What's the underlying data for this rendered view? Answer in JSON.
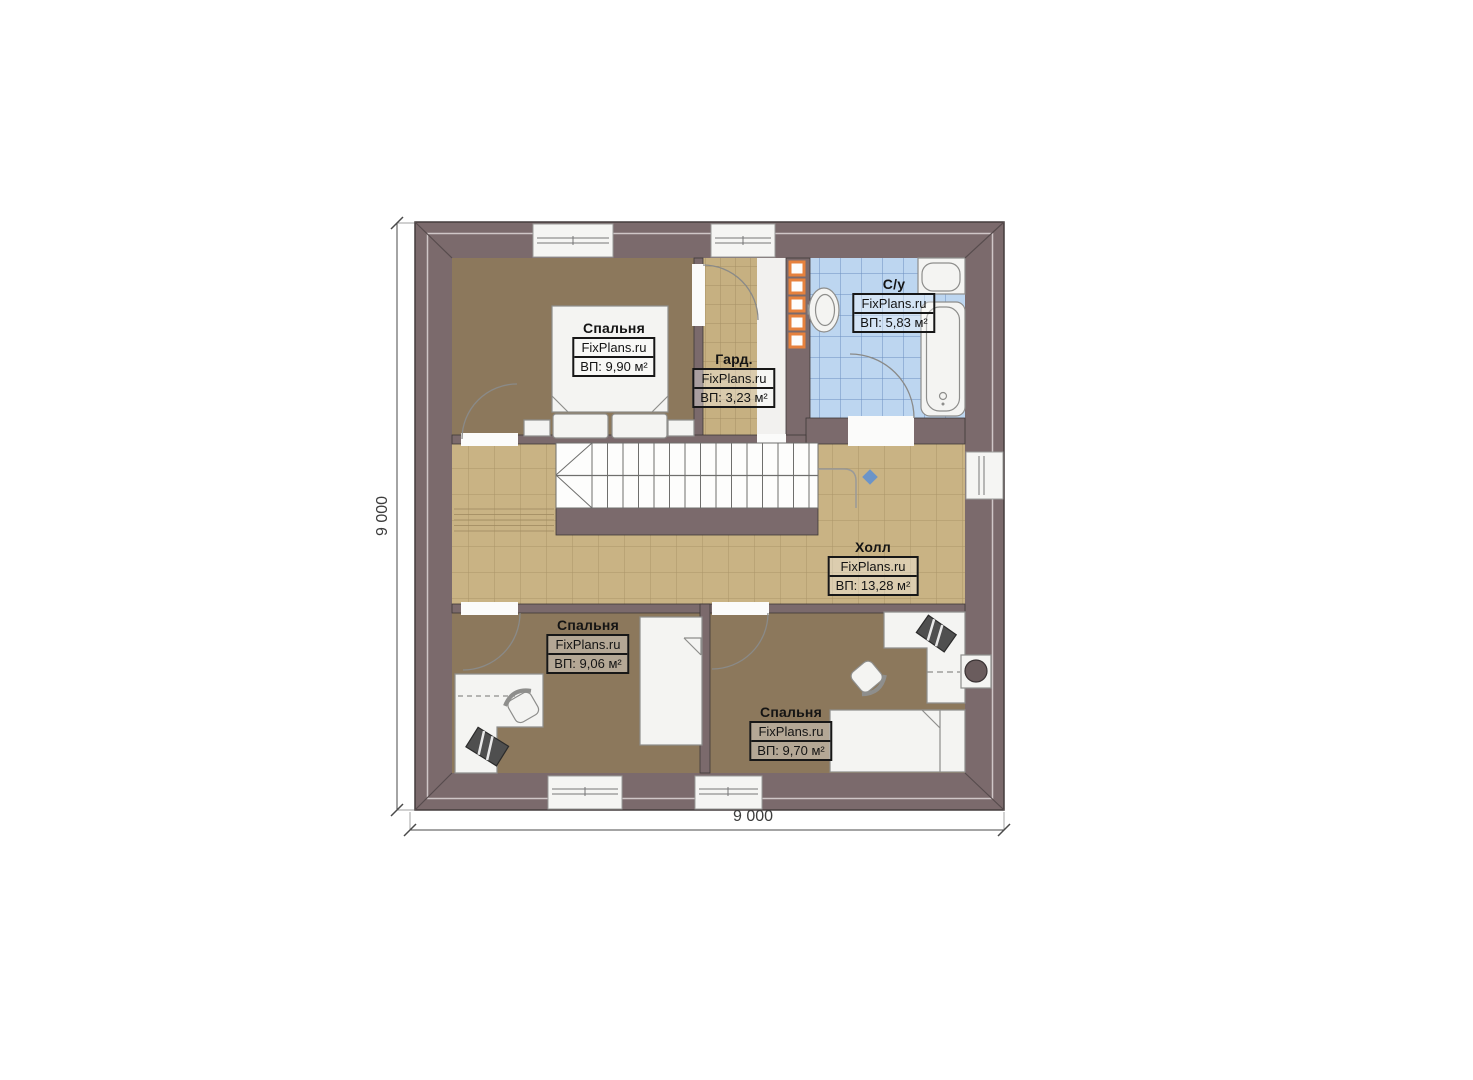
{
  "plan": {
    "watermark": "FixPlans.ru",
    "dimensions": {
      "width_label": "9 000",
      "height_label": "9 000"
    },
    "rooms": [
      {
        "id": "bedroom-top",
        "name": "Спальня",
        "area": "ВП: 9,90 м²"
      },
      {
        "id": "wardrobe",
        "name": "Гард.",
        "area": "ВП: 3,23 м²"
      },
      {
        "id": "bathroom",
        "name": "С/у",
        "area": "ВП: 5,83 м²"
      },
      {
        "id": "hall",
        "name": "Холл",
        "area": "ВП: 13,28 м²"
      },
      {
        "id": "bedroom-bottom-left",
        "name": "Спальня",
        "area": "ВП: 9,06 м²"
      },
      {
        "id": "bedroom-bottom-right",
        "name": "Спальня",
        "area": "ВП: 9,70 м²"
      }
    ],
    "colors": {
      "wall": "#7b6a6c",
      "bedroom_floor": "#8c785c",
      "hall_floor": "#c9b384",
      "bath_floor": "#bdd6f0",
      "accent_orange": "#e6813d",
      "marker_blue": "#6b94c8"
    }
  }
}
